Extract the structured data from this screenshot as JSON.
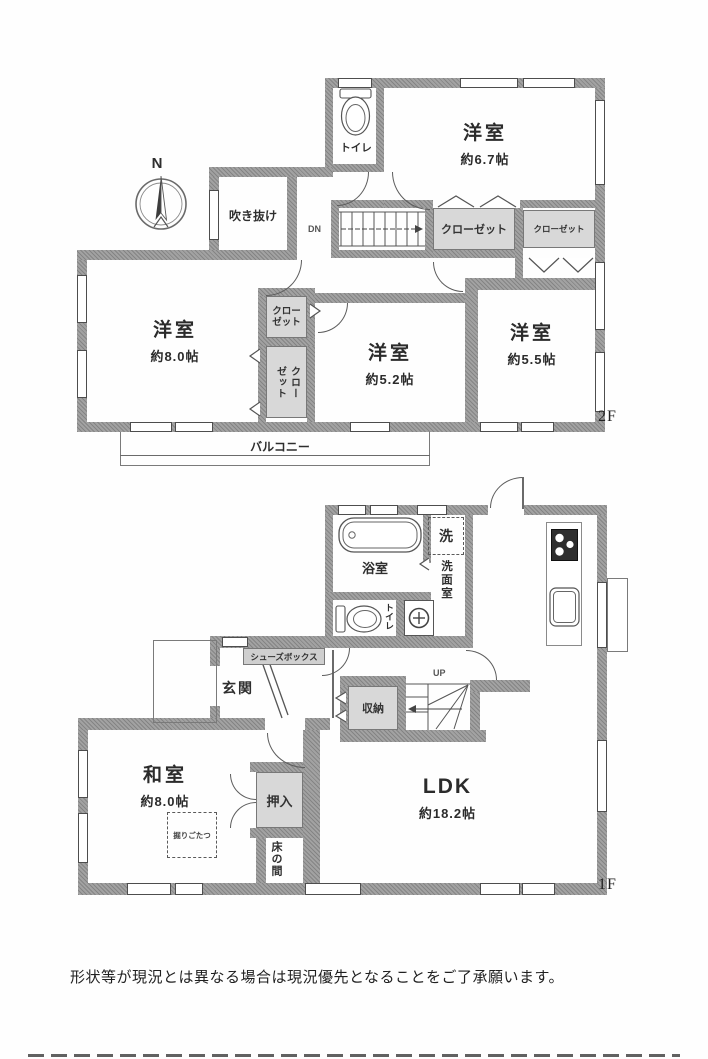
{
  "meta": {
    "compass_n": "N",
    "floor2_label": "2F",
    "floor1_label": "1F",
    "disclaimer": "形状等が現況とは異なる場合は現況優先となることをご了承願います。"
  },
  "floor2": {
    "toilet": "トイレ",
    "void_space": "吹き抜け",
    "stairs_down": "DN",
    "closet_wide": "クローゼット",
    "closet_small": "クローゼット",
    "closet_center_upper": "クローゼット",
    "closet_center_lower": "クローゼット",
    "room_ne": {
      "name": "洋室",
      "size": "約6.7帖"
    },
    "room_w": {
      "name": "洋室",
      "size": "約8.0帖"
    },
    "room_c": {
      "name": "洋室",
      "size": "約5.2帖"
    },
    "room_e": {
      "name": "洋室",
      "size": "約5.5帖"
    },
    "balcony": "バルコニー"
  },
  "floor1": {
    "bath": "浴室",
    "laundry": "洗",
    "washroom": "洗面室",
    "toilet": "トイレ",
    "entrance": "玄関",
    "shoe_box": "シューズボックス",
    "storage": "収納",
    "stairs_up": "UP",
    "japanese_room": {
      "name": "和室",
      "size": "約8.0帖"
    },
    "kotatsu": "掘りごたつ",
    "oshiire": "押入",
    "tokonoma": "床の間",
    "ldk": {
      "name": "LDK",
      "size": "約18.2帖"
    }
  }
}
